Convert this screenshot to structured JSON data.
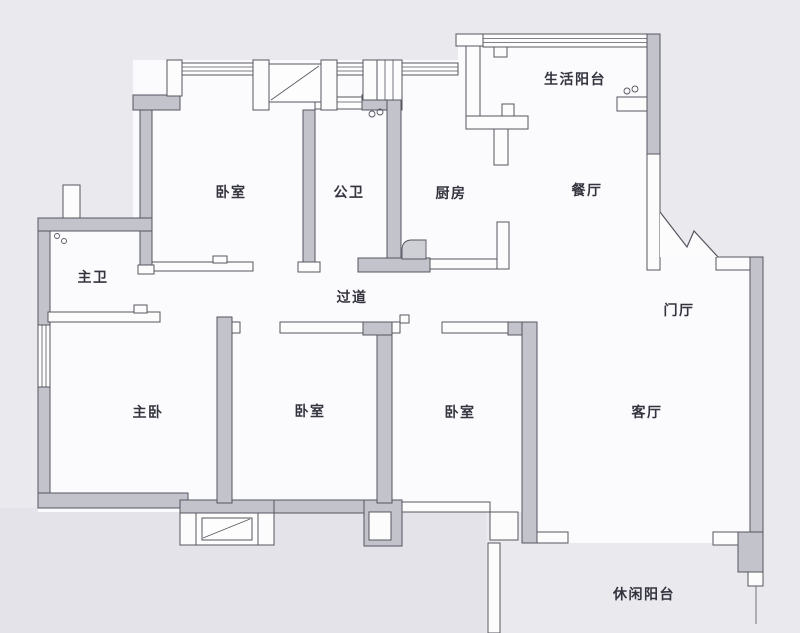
{
  "plan": {
    "type": "apartment-floor-plan",
    "background_color": "#e9e9ee",
    "room_fill_color": "#fbfbfd",
    "wall_fill_color": "#c3c3cc",
    "line_color": "#56565f",
    "label_color": "#34343f",
    "outside_shade_color": "#e3e3e9",
    "door_leaf_color": "#cfcfd6"
  },
  "rooms": [
    {
      "id": "bedroom-top",
      "label": "卧室"
    },
    {
      "id": "public-bathroom",
      "label": "公卫"
    },
    {
      "id": "kitchen",
      "label": "厨房"
    },
    {
      "id": "dining-room",
      "label": "餐厅"
    },
    {
      "id": "service-balcony",
      "label": "生活阳台"
    },
    {
      "id": "master-bathroom",
      "label": "主卫"
    },
    {
      "id": "hallway",
      "label": "过道"
    },
    {
      "id": "foyer",
      "label": "门厅"
    },
    {
      "id": "master-bedroom",
      "label": "主卧"
    },
    {
      "id": "bedroom-middle",
      "label": "卧室"
    },
    {
      "id": "bedroom-right",
      "label": "卧室"
    },
    {
      "id": "living-room",
      "label": "客厅"
    },
    {
      "id": "leisure-balcony",
      "label": "休闲阳台"
    }
  ]
}
